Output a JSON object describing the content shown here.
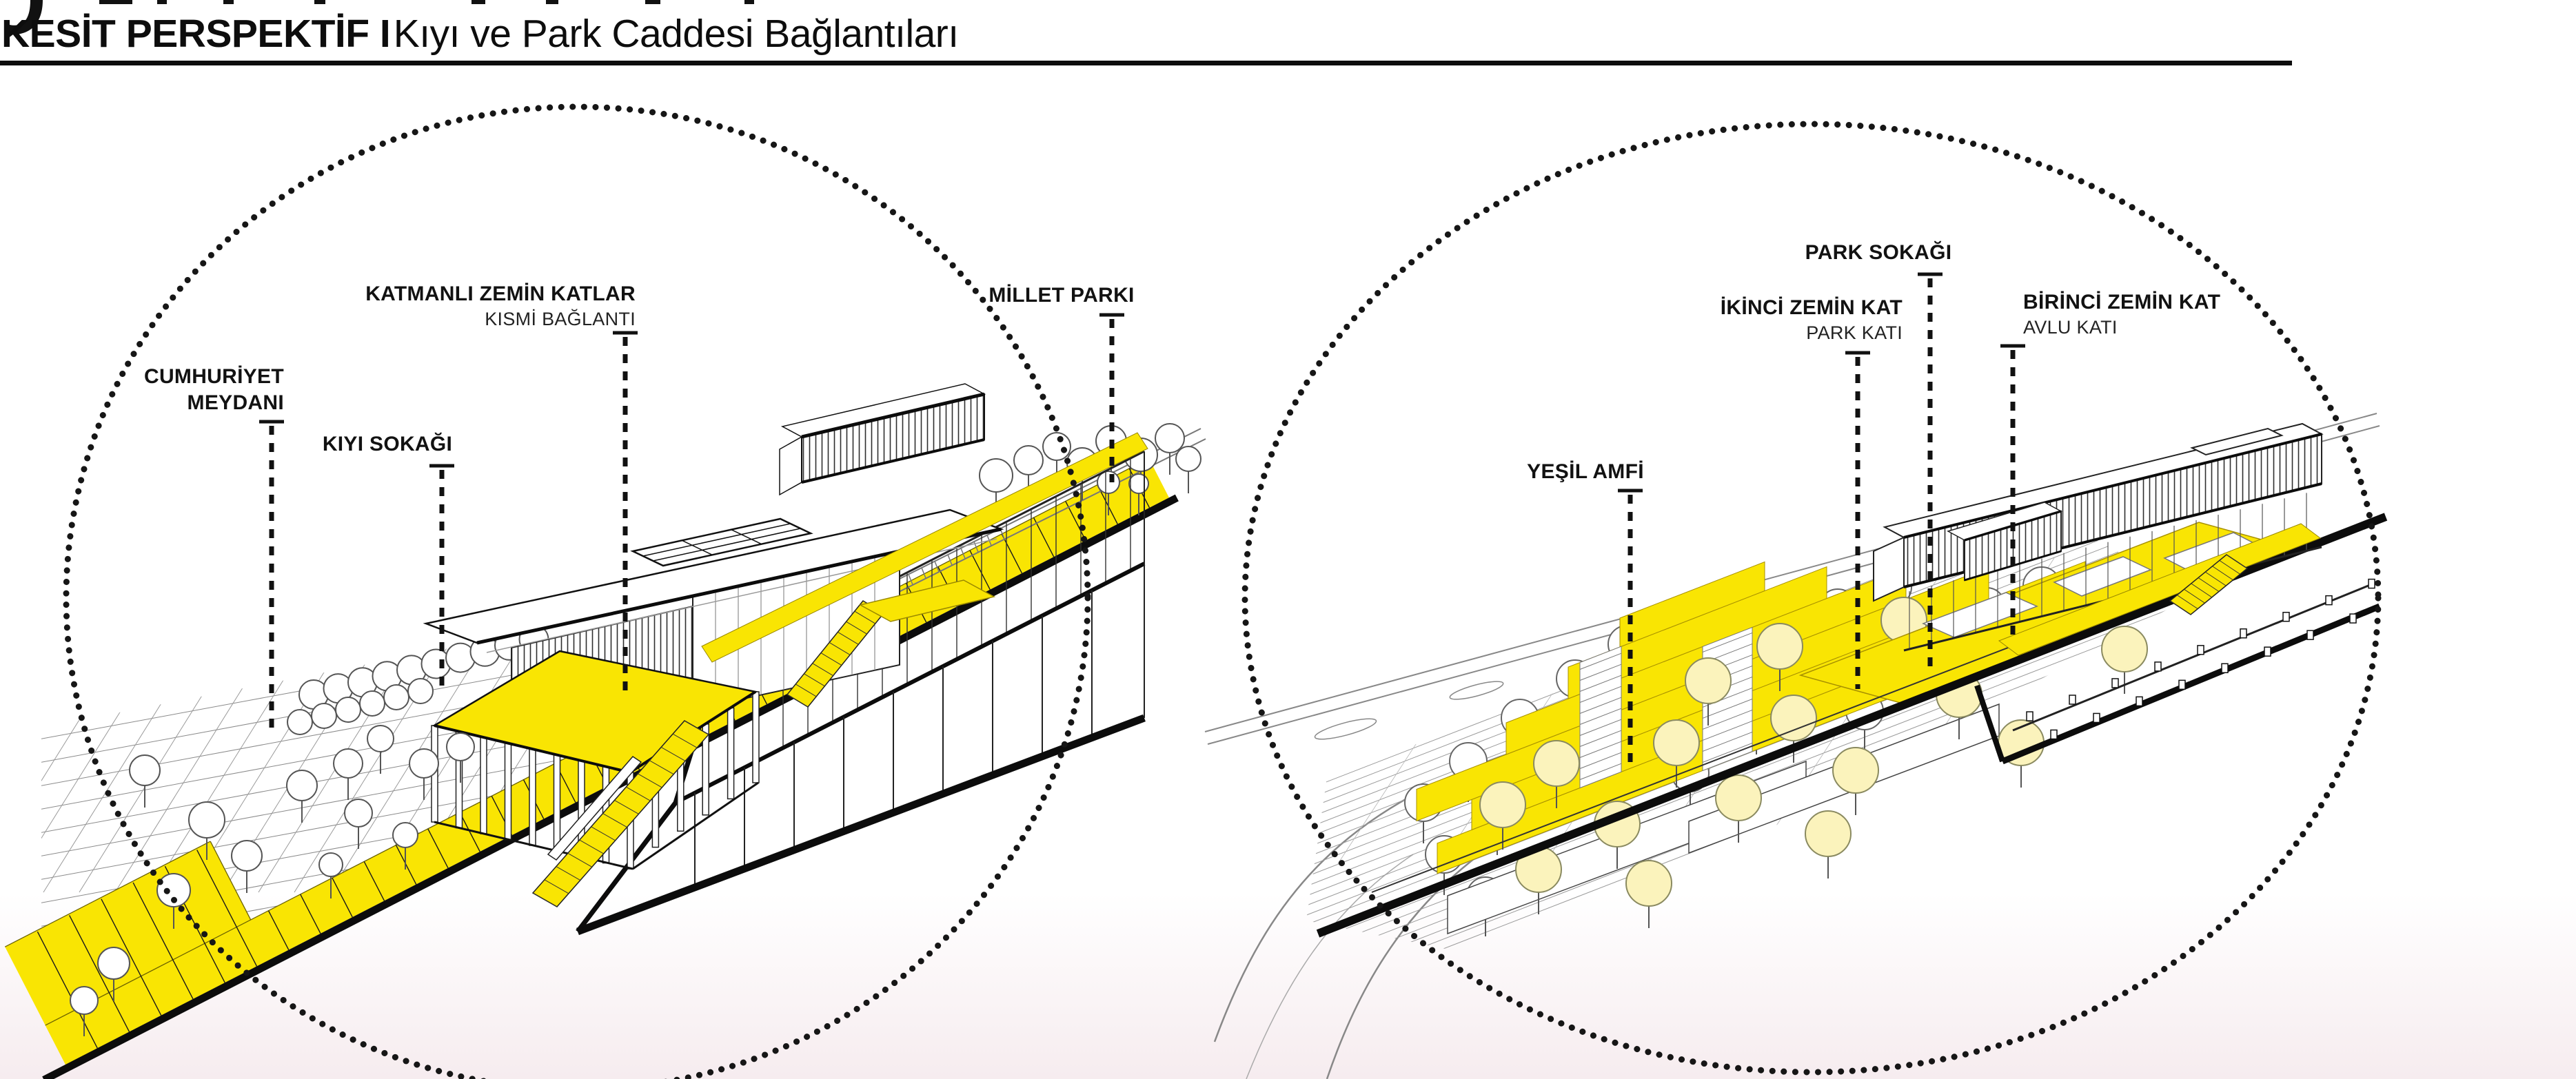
{
  "header": {
    "title_bold": "KESİT PERSPEKTİF I",
    "title_regular": "Kıyı ve Park Caddesi Bağlantıları"
  },
  "colors": {
    "highlight_yellow": "#F9E503",
    "pale_tree_yellow": "#FBF3BC",
    "ink": "#111111"
  },
  "left_diagram": {
    "labels": {
      "cumhuriyet_meydani": {
        "line1": "CUMHURİYET",
        "line2": "MEYDANI"
      },
      "kiyi_sokagi": {
        "line1": "KIYI SOKAĞI"
      },
      "katmanli_zemin_katlar": {
        "line1": "KATMANLI ZEMİN KATLAR",
        "line2": "KISMİ BAĞLANTI"
      },
      "millet_parki": {
        "line1": "MİLLET PARKI"
      }
    }
  },
  "right_diagram": {
    "labels": {
      "yesil_amfi": {
        "line1": "YEŞİL AMFİ"
      },
      "ikinci_zemin_kat": {
        "line1": "İKİNCİ ZEMİN KAT",
        "line2": "PARK KATI"
      },
      "park_sokagi": {
        "line1": "PARK SOKAĞI"
      },
      "birinci_zemin_kat": {
        "line1": "BİRİNCİ ZEMİN KAT",
        "line2": "AVLU KATI"
      }
    }
  }
}
